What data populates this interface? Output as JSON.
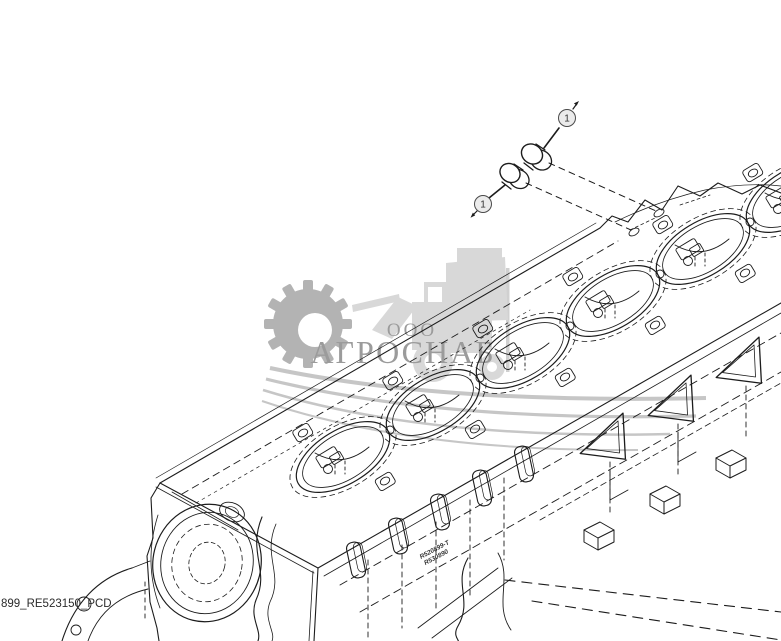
{
  "diagram": {
    "part_label": "899_RE523150_PCD",
    "callouts": [
      {
        "number": "1"
      },
      {
        "number": "1"
      }
    ],
    "stamp": {
      "line1": "R520899-T",
      "line2": "R530890"
    },
    "line_color": "#1c1c1c"
  },
  "watermark": {
    "company_prefix": "ООО",
    "company_name": "АГРОСНАБ",
    "text_color": "#9b9b9b",
    "gear_color": "#b3b3b3",
    "swoosh_color": "#c6c6c6",
    "vehicle_color": "#d8d8d8"
  }
}
